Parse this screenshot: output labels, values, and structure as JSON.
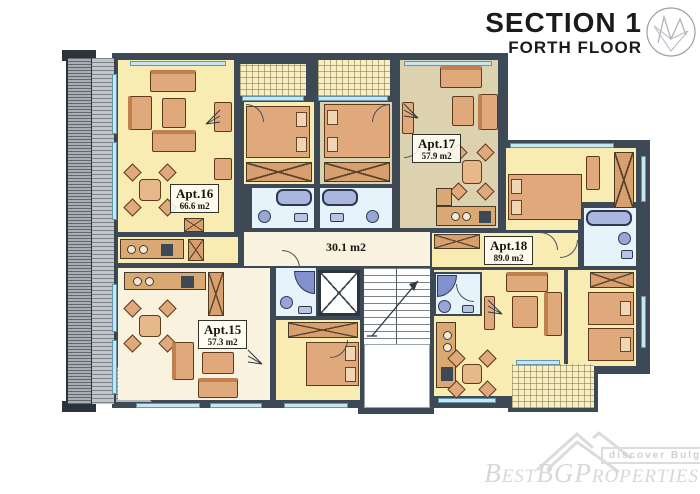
{
  "header": {
    "title": "SECTION 1",
    "subtitle": "FORTH FLOOR"
  },
  "apartments": {
    "apt15": {
      "name": "Apt.15",
      "area": "57.3 m2"
    },
    "apt16": {
      "name": "Apt.16",
      "area": "66.6 m2"
    },
    "apt17": {
      "name": "Apt.17",
      "area": "57.9 m2"
    },
    "apt18": {
      "name": "Apt.18",
      "area": "89.0 m2"
    }
  },
  "common_area_label": "30.1 m2",
  "watermark": {
    "tagline": "discover Bulgaria",
    "brand": "BestBGProperties"
  },
  "legend_colors": {
    "walls": "#3d4a56",
    "apartment_yellow": "#f8ecb2",
    "apartment_beige": "#dcd2b0",
    "apartment_cream": "#f8f2de",
    "bathroom_blue": "#e7f3fa",
    "furniture": "#dfa97c",
    "terrace_gray": "#b6bbc0",
    "window_blue": "#c4e7f3"
  }
}
